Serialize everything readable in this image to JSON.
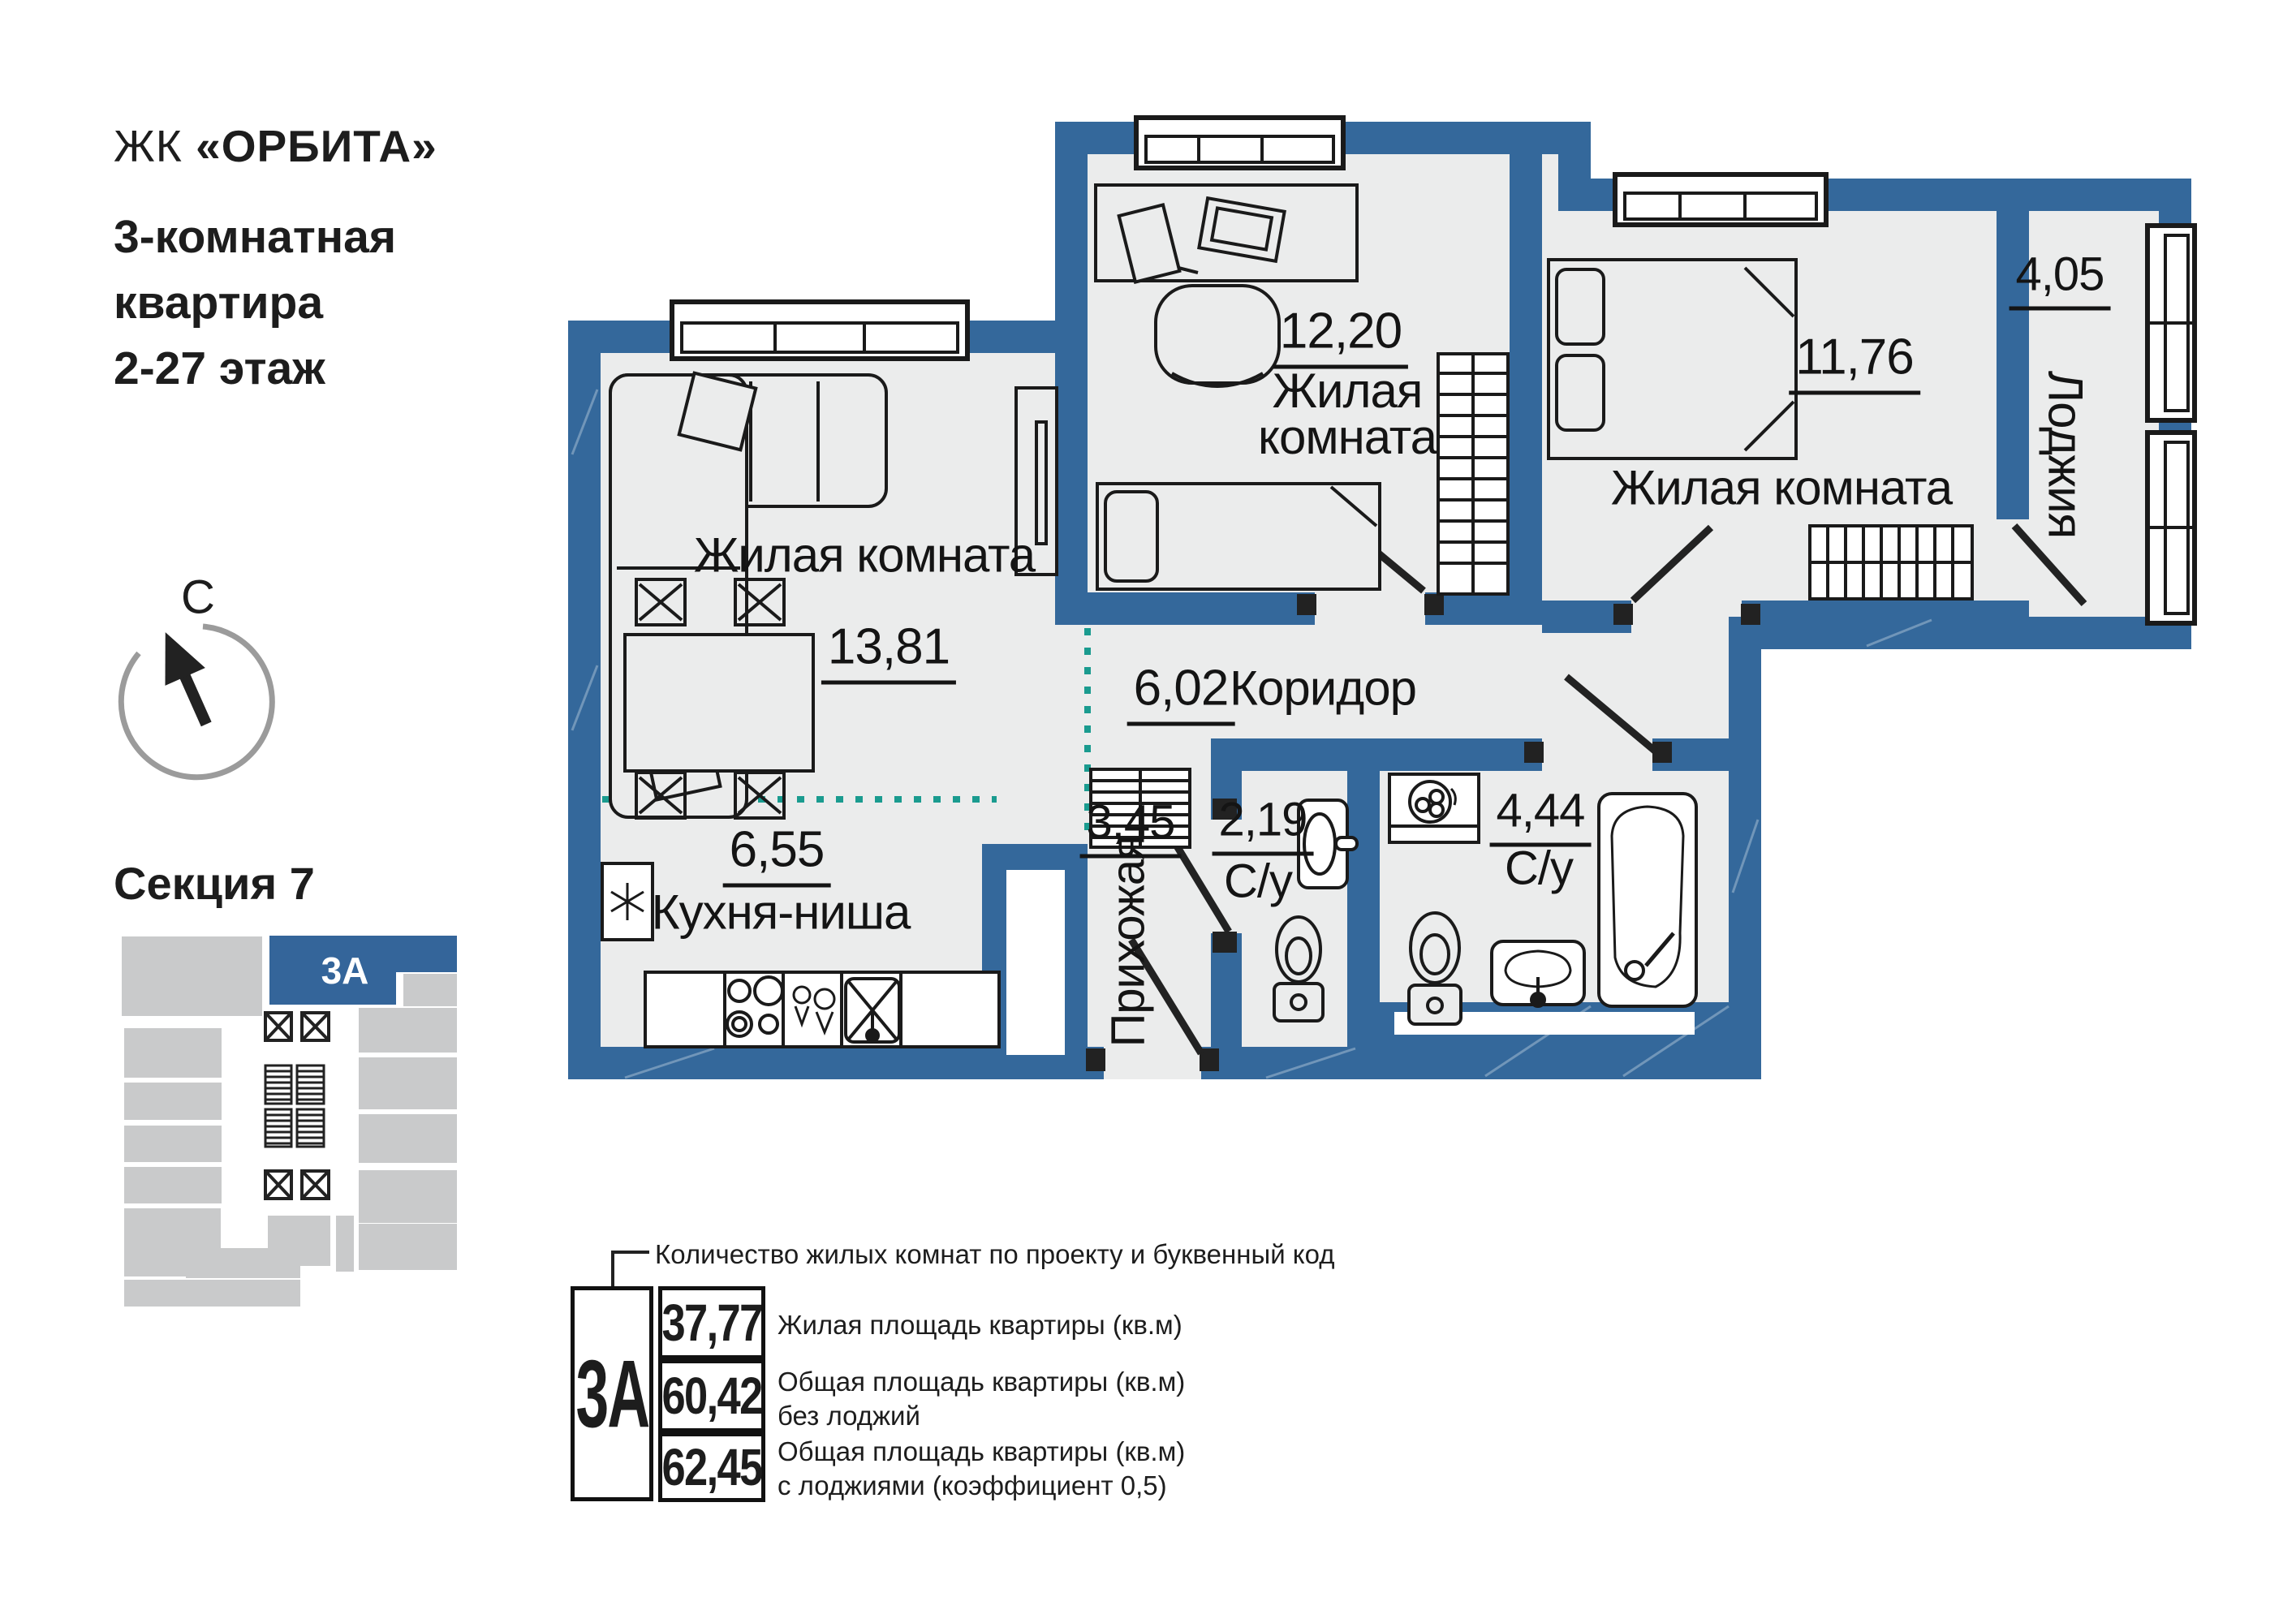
{
  "header": {
    "complex_prefix": "ЖК",
    "complex_name": "«ОРБИТА»",
    "subtitle_lines": [
      "3-комнатная",
      "квартира",
      "2-27 этаж"
    ]
  },
  "compass": {
    "north_label": "С"
  },
  "section": {
    "title": "Секция 7",
    "unit_code": "3А"
  },
  "plan": {
    "rooms": [
      {
        "name": "Жилая комната",
        "area": "13,81"
      },
      {
        "name": "Жилая комната",
        "area": "12,20"
      },
      {
        "name": "Жилая комната",
        "area": "11,76"
      },
      {
        "name": "Лоджия",
        "area": "4,05"
      },
      {
        "name": "Коридор",
        "area": "6,02"
      },
      {
        "name": "Кухня-ниша",
        "area": "6,55"
      },
      {
        "name": "Прихожая",
        "area": "3,45"
      },
      {
        "name": "С/у",
        "area": "2,19"
      },
      {
        "name": "С/у",
        "area": "4,44"
      }
    ]
  },
  "legend": {
    "callout": "Количество жилых комнат по проекту и буквенный код",
    "unit_code": "3А",
    "rows": [
      {
        "value": "37,77",
        "lines": [
          "Жилая площадь квартиры (кв.м)"
        ]
      },
      {
        "value": "60,42",
        "lines": [
          "Общая площадь квартиры (кв.м)",
          "без лоджий"
        ]
      },
      {
        "value": "62,45",
        "lines": [
          "Общая площадь квартиры (кв.м)",
          "с лоджиями (коэффициент 0,5)"
        ]
      }
    ]
  },
  "colors": {
    "wall_blue": "#34689b",
    "floor_gray": "#ebecec",
    "accent_teal": "#1a9b8f",
    "minimap_gray": "#c9cacb",
    "minimap_blue": "#34659a",
    "line_black": "#1a1a1a"
  }
}
